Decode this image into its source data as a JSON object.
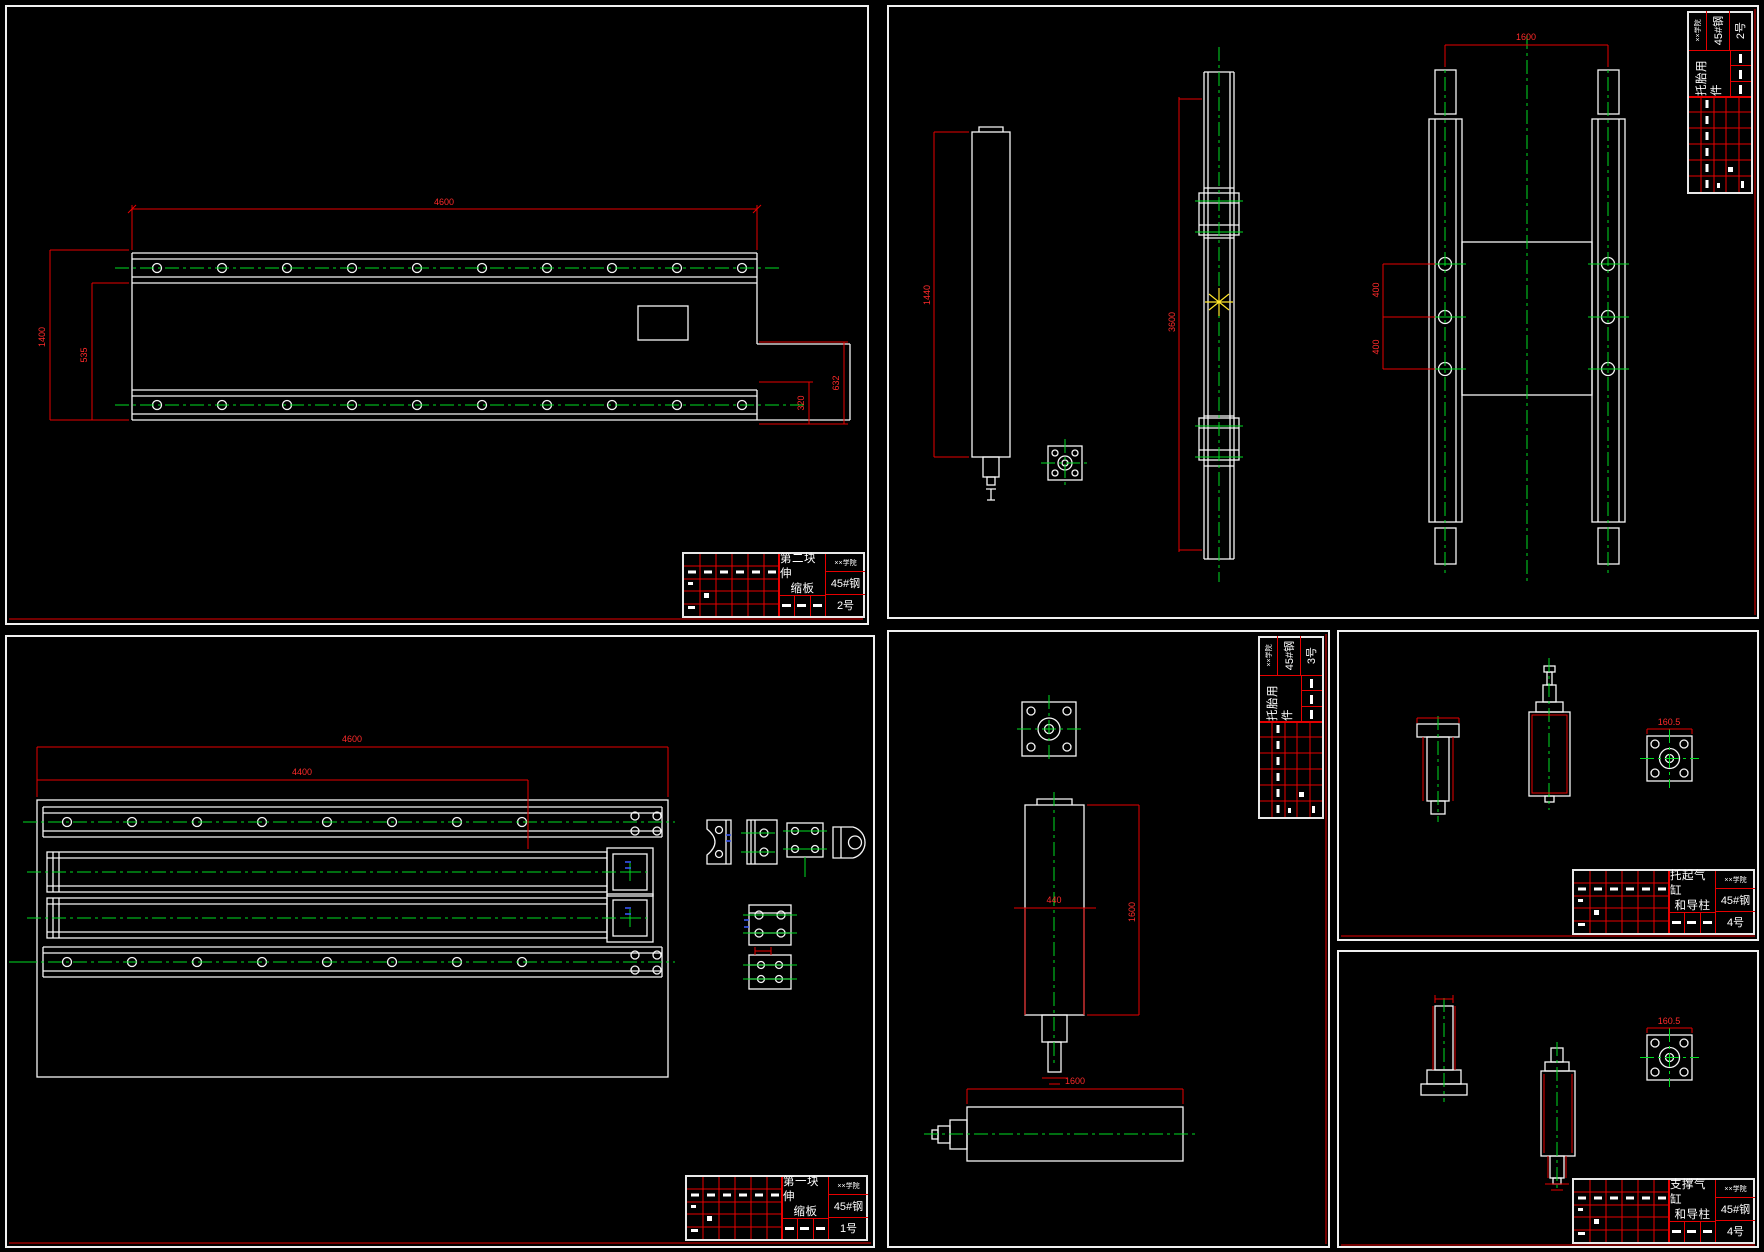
{
  "colors": {
    "background": "#000000",
    "geometry": "#ffffff",
    "dimension": "#e60000",
    "centerline": "#00dd22",
    "detail": "#3a5bff",
    "highlight": "#ffe52a",
    "titleblock_grid": "#ff0000"
  },
  "panels": {
    "p1": {
      "title_block": {
        "name_l1": "第二块伸",
        "name_l2": "缩板",
        "school": "××学院",
        "material": "45#钢",
        "sheet": "2号"
      },
      "dims": {
        "overall": "4600",
        "height": "1400",
        "inner_height": "535",
        "step_height": "632",
        "step_inner": "320"
      }
    },
    "p2": {
      "title_block": {
        "name_l1": "托胎用件",
        "name_l2": "",
        "school": "××学院",
        "material": "45#钢",
        "sheet": "2号"
      },
      "dims": {
        "cylinder_length": "1440",
        "rail_length": "3600",
        "frame_width": "1600",
        "hole_pitch_a": "400",
        "hole_pitch_b": "400"
      }
    },
    "p3": {
      "title_block": {
        "name_l1": "第一块伸",
        "name_l2": "缩板",
        "school": "××学院",
        "material": "45#钢",
        "sheet": "1号"
      },
      "dims": {
        "overall": "4600",
        "inner": "4400"
      }
    },
    "p4": {
      "title_block": {
        "name_l1": "托胎用件",
        "name_l2": "",
        "school": "××学院",
        "material": "45#钢",
        "sheet": "3号"
      },
      "dims": {
        "width": "440",
        "length": "1600",
        "h_cylinder_length": "1600"
      }
    },
    "p5": {
      "title_block": {
        "name_l1": "托起气缸",
        "name_l2": "和导柱",
        "school": "××学院",
        "material": "45#钢",
        "sheet": "4号"
      },
      "dims": {
        "flange": "160.5"
      }
    },
    "p6": {
      "title_block": {
        "name_l1": "支撑气缸",
        "name_l2": "和导柱",
        "school": "××学院",
        "material": "45#钢",
        "sheet": "4号"
      },
      "dims": {
        "flange": "160.5"
      }
    }
  }
}
